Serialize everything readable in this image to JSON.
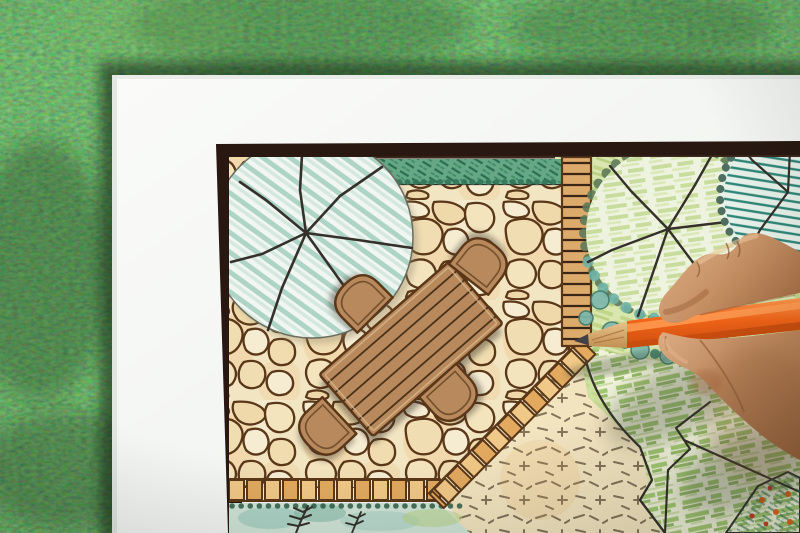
{
  "meta": {
    "domain": "Natural-Image",
    "alt": "Overhead photograph of a landscape designer's hand drawing a backyard garden design plan in colored pencil on a sheet lying on green grass"
  },
  "scene": {
    "background": {
      "label": "Green grass lawn background"
    },
    "paper": {
      "label": "White drawing sheet"
    },
    "plan": {
      "label": "Hand-drawn backyard landscape plan",
      "frame_label": "Dark plan border frame",
      "patio_label": "Flagstone patio paving",
      "edging_label": "Brick patio edging",
      "shade_tree_label": "Large shade tree plan symbol with teal hatching",
      "hedge_label": "Clipped hedge row",
      "walkway_label": "Timber walkway strip",
      "garden_label": "Planted garden area",
      "tree2_label": "Deciduous tree plan symbol with scalloped canopy",
      "tree3_label": "Evergreen tree plan symbol with teal hatching",
      "shrubs_label": "Shrub border",
      "lawn_label": "Lawn with green pencil hatching",
      "groundcover_label": "Groundcover bed with dash marks",
      "fern_bed_label": "Fern planting bed",
      "flower_bed_label": "Corner flower bed",
      "table_label": "Outdoor dining table plan symbol",
      "chair_label": "Patio chair plan symbol"
    },
    "hand": {
      "label": "Designer's right hand holding pencil"
    },
    "pencil": {
      "label": "Orange colored pencil"
    }
  },
  "colors": {
    "grass_base": "#4c7c3e",
    "paper": "#f6f8f5",
    "frame_brown": "#281811",
    "ink_dark": "#35302a",
    "joint_brown": "#5a3718",
    "stone_cream": "#f2e5c2",
    "brick_tan": "#e9b873",
    "teal_stripe": "#add4c6",
    "teal_deep": "#2f8577",
    "hedge_green": "#66a886",
    "garden_green": "#d9e6ae",
    "lawn_cream": "#f0f2d9",
    "lawn_green": "#96bf65",
    "wood_brown": "#b8895c",
    "bed_aqua": "#cfe3d6",
    "groundcover_tan": "#f2e4bf",
    "dash_brown": "#6f6049",
    "skin_light": "#dcab82",
    "skin_mid": "#c08a5e",
    "skin_dark": "#8a5632",
    "pencil_orange": "#f26418",
    "pencil_highlight": "#ff9c52",
    "pencil_shadow": "#c84c0e",
    "pencil_wood": "#dcab6e",
    "pencil_lead": "#424246"
  }
}
